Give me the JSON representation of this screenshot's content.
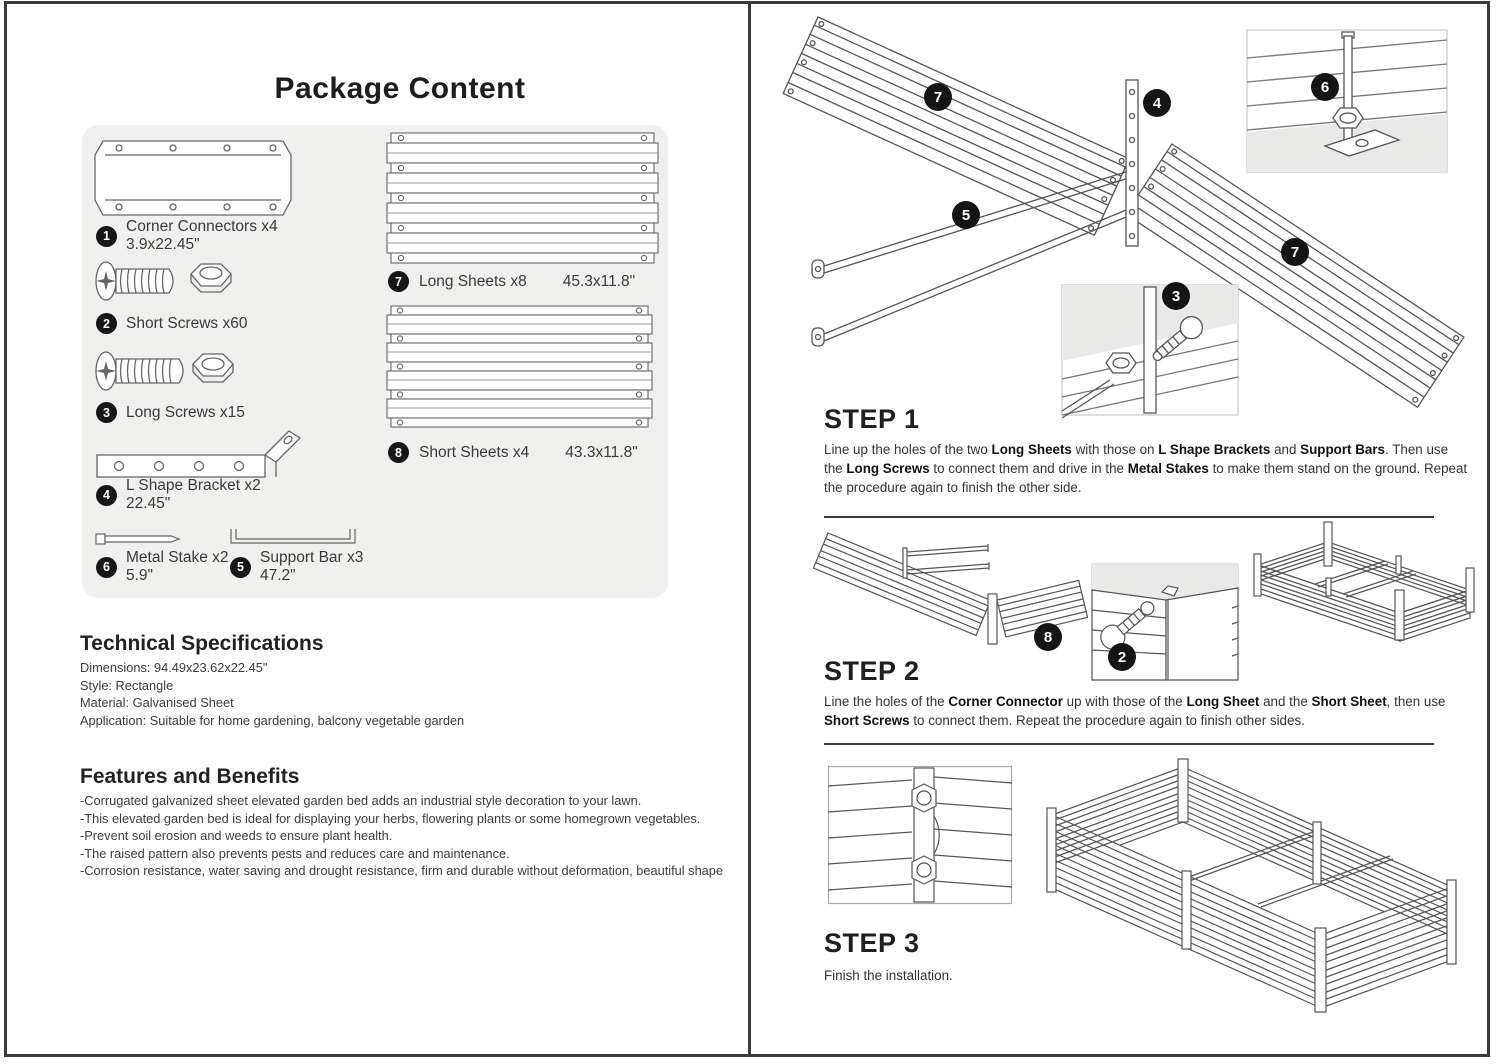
{
  "colors": {
    "panel_bg": "#f0f0ee",
    "inset_bg": "#e9e9e7",
    "line": "#555555",
    "frame": "#3a3a3a",
    "badge": "#161616"
  },
  "left": {
    "title": "Package Content",
    "package_items": [
      {
        "num": "1",
        "label": "Corner Connectors x4",
        "dim": "3.9x22.45\""
      },
      {
        "num": "2",
        "label": "Short Screws x60",
        "dim": ""
      },
      {
        "num": "3",
        "label": "Long Screws x15",
        "dim": ""
      },
      {
        "num": "4",
        "label": "L Shape Bracket x2",
        "dim": "22.45\""
      },
      {
        "num": "6",
        "label": "Metal Stake x2",
        "dim": "5.9\""
      },
      {
        "num": "5",
        "label": "Support Bar x3",
        "dim": "47.2\""
      },
      {
        "num": "7",
        "label": "Long Sheets x8",
        "dim": "45.3x11.8\""
      },
      {
        "num": "8",
        "label": "Short Sheets x4",
        "dim": "43.3x11.8\""
      }
    ],
    "specs": {
      "heading": "Technical Specifications",
      "lines": [
        "Dimensions: 94.49x23.62x22.45\"",
        "Style: Rectangle",
        "Material: Galvanised Sheet",
        "Application: Suitable for home gardening, balcony vegetable garden"
      ]
    },
    "features": {
      "heading": "Features and Benefits",
      "lines": [
        "-Corrugated galvanized sheet elevated garden bed adds an industrial style decoration to your lawn.",
        "-This elevated garden bed is ideal for displaying your herbs, flowering plants or some homegrown vegetables.",
        "-Prevent soil erosion and weeds to ensure plant health.",
        "-The raised pattern also prevents pests and reduces care and maintenance.",
        "-Corrosion resistance, water saving and drought resistance, firm and durable without deformation, beautiful shape"
      ]
    }
  },
  "right": {
    "steps": [
      {
        "heading": "STEP 1",
        "body_html": "Line up the holes of the two <b>Long Sheets</b> with those on <b>L Shape Brackets</b> and <b>Support Bars</b>. Then use the <b>Long Screws</b> to connect them and drive in the <b>Metal Stakes</b> to make them stand on the ground. Repeat the procedure again to finish the other side."
      },
      {
        "heading": "STEP 2",
        "body_html": "Line the holes of the <b>Corner Connector</b> up with those of the <b>Long Sheet</b> and the <b>Short Sheet</b>, then use <b>Short Screws</b> to connect them. Repeat the procedure again to finish other sides."
      },
      {
        "heading": "STEP 3",
        "body_html": "Finish the installation."
      }
    ],
    "badges": {
      "step1": [
        "7",
        "4",
        "6",
        "5",
        "3",
        "7"
      ],
      "step2": [
        "8",
        "2"
      ]
    }
  }
}
